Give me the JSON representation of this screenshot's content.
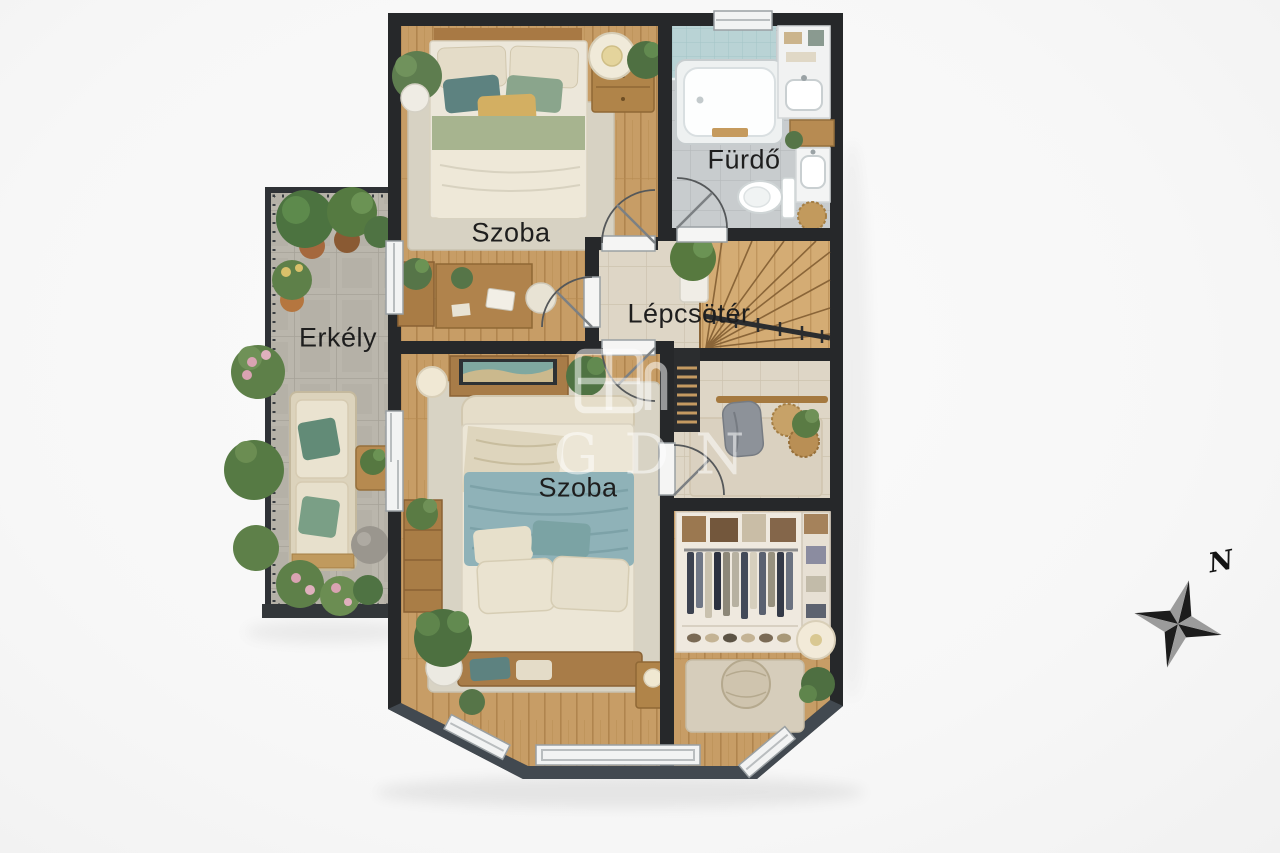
{
  "scene": {
    "type": "floor-plan-render",
    "background": "#f7f7f7",
    "labels": {
      "room_top": "Szoba",
      "bathroom": "Fürdő",
      "stairwell": "Lépcsötér",
      "balcony": "Erkély",
      "room_bottom": "Szoba"
    },
    "watermark": {
      "text": "GDN",
      "icon": "house-window-icon"
    },
    "compass": {
      "north_label": "N"
    },
    "colors": {
      "wall": "#26282a",
      "bay_wall": "#424950",
      "wood_floor": "#c79d66",
      "stair_wood": "#d4ac74",
      "beige_tile": "#ded6c6",
      "gray_tile": "#c8ccce",
      "aqua_tile": "#b9d3d5",
      "balcony_stone": "#bab6ac",
      "rug_beige": "#d7d2c3",
      "blanket_green": "#a7b48f",
      "blanket_blue": "#8fb2b8",
      "plant_green": "#557a41",
      "furniture_wood": "#b0834c"
    }
  }
}
